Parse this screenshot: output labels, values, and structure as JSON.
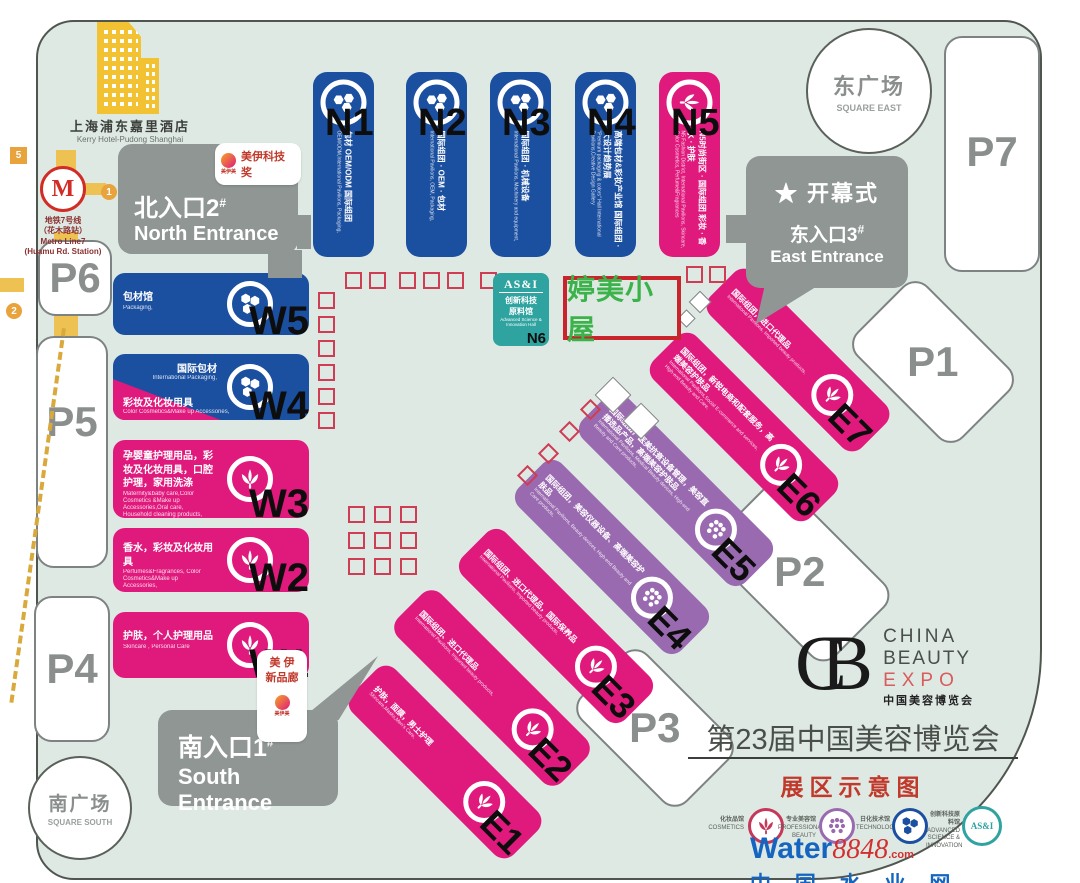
{
  "colors": {
    "blue": "#1b4fa0",
    "pink": "#e0197d",
    "purple": "#9a6ab0",
    "teal": "#2fa3a0",
    "map_bg": "#dfe9e4",
    "entrance_gray": "#8f9694",
    "booth_red": "#cf3d55",
    "highlight_green": "#3bb34a",
    "highlight_border": "#c9242b",
    "road_yellow": "#eec153"
  },
  "hotel": {
    "zh": "上海浦东嘉里酒店",
    "en": "Kerry Hotel-Pudong Shanghai"
  },
  "metro": {
    "line1": "地铁7号线",
    "line2": "（花木路站）",
    "en1": "Metro Line7",
    "en2": "(Huamu Rd. Station)",
    "marker5": "5",
    "marker1": "1",
    "marker2": "2",
    "logo": "M"
  },
  "entrances": {
    "north": {
      "zh": "北入口2",
      "hash": "#",
      "en": "North Entrance"
    },
    "east": {
      "ceremony": "★ 开幕式",
      "zh": "东入口3",
      "hash": "#",
      "en": "East Entrance"
    },
    "south": {
      "zh": "南入口1",
      "hash": "#",
      "en": "South Entrance"
    }
  },
  "badges": {
    "tech_award": {
      "text": "美伊科技奖",
      "logo": "美伊美"
    },
    "new_gallery": {
      "line1": "美 伊",
      "line2": "新品廊",
      "logo": "美伊美"
    }
  },
  "highlight": {
    "text": "婷美小屋"
  },
  "halls_n": [
    {
      "code": "N1",
      "zh": "包材 OEM/ODM 国际组团",
      "en": "OEM/ODM,International Pavilions, Packaging,"
    },
    {
      "code": "N2",
      "zh": "国际组团 · OEM · 包材",
      "en": "International Pavilions, OEM, Packaging,"
    },
    {
      "code": "N3",
      "zh": "国际组团 · 机械设备",
      "en": "International Pavilions, Machinery and equipment,"
    },
    {
      "code": "N4",
      "zh": "高端包材&彩妆产业馆 国际组团 · 大设计趋势展",
      "en": "\"Premium packaging & colors\" Hall International Pavilions,Creative Design Gallery"
    },
    {
      "code": "N5",
      "zh": "N5时尚街区 · 国际组团 彩妆 · 香水 · 护肤",
      "en": "N5 Fashion District, International Pavilions, Skincare, Color Cosmetics, Perfume&Fragrances"
    }
  ],
  "hall_n6": {
    "logo": "AS&I",
    "zh1": "创新科技",
    "zh2": "原料馆",
    "en1": "Advanced Science &",
    "en2": "Innovation Hall",
    "code": "N6"
  },
  "halls_w": [
    {
      "code": "W5",
      "zh": "包材馆",
      "en": "Packaging,"
    },
    {
      "code": "W4",
      "zh_top": "国际包材",
      "en_top": "International Packaging,",
      "zh_bottom": "彩妆及化妆用具",
      "en_bottom": "Color Cosmetics&Make up Accessories,"
    },
    {
      "code": "W3",
      "zh": "孕婴童护理用品，彩妆及化妆用具，口腔护理，家用洗涤",
      "en": "Maternity&baby care,Color Cosmetics &Make up Accessories,Oral care, Household cleaning products,"
    },
    {
      "code": "W2",
      "zh": "香水，彩妆及化妆用具",
      "en": "Perfumes&Fragrances, Color Cosmetics&Make up Accessories,"
    },
    {
      "code": "W1",
      "zh": "护肤，个人护理用品",
      "en": "Skincare , Personal Care"
    }
  ],
  "halls_e": [
    {
      "code": "E1",
      "zh": "护肤，面膜，男士护理",
      "en": "Skincare,Masks,Men's Care,"
    },
    {
      "code": "E2",
      "zh": "国际组团、进口代理品",
      "en": "International Pavilions, Imported beauty products,"
    },
    {
      "code": "E3",
      "zh": "国际组团、进口代理品，国际保养品",
      "en": "International Pavilions, Imported beauty products,"
    },
    {
      "code": "E4",
      "zh": "国际组团，美容仪器设备、高端美容护肤品",
      "en": "International Pavilions, Beauty devices, High-end Beauty and Care products,"
    },
    {
      "code": "E5",
      "zh": "国际组团，医美抗衰设备管理，美容直播选品产品，高端美容护肤品",
      "en": "International Pavilions, Medical Beauty devices, High-end Beauty and Care products,"
    },
    {
      "code": "E6",
      "zh": "国际组团，新锐电商和配套服务，高端美容护肤品",
      "en": "International Pavilions,Social E-commerce and services, High-end Beauty and Care,"
    },
    {
      "code": "E7",
      "zh": "国际组团，进口代理品",
      "en": "International Pavilions, Imported beauty products,"
    }
  ],
  "parking": {
    "p1": "P1",
    "p2": "P2",
    "p3": "P3",
    "p4": "P4",
    "p5": "P5",
    "p6": "P6",
    "p7": "P7"
  },
  "plazas": {
    "east_zh": "东广场",
    "east_en": "SQUARE EAST",
    "south_zh": "南广场",
    "south_en": "SQUARE SOUTH"
  },
  "footer": {
    "logo": {
      "mark": "CB",
      "china": "CHINA",
      "beauty": "BEAUTY",
      "expo": "EXPO",
      "cn": "中国美容博览会"
    },
    "title": "第23届中国美容博览会",
    "subtitle": "展区示意图",
    "legend": [
      {
        "zh": "化妆品馆",
        "en": "COSMETICS"
      },
      {
        "zh": "专业美容馆",
        "en": "PROFESSIONAL BEAUTY"
      },
      {
        "zh": "日化技术馆",
        "en": "TECHNOLOGY"
      },
      {
        "zh": "创新科技原料馆",
        "en": "ADVANCED SCIENCE & INNOVATION",
        "icon_text": "AS&I"
      }
    ],
    "watermark": {
      "word": "Water",
      "num": "8848",
      "dotcom": ".com",
      "cn": "中 国 水 业 网"
    }
  }
}
